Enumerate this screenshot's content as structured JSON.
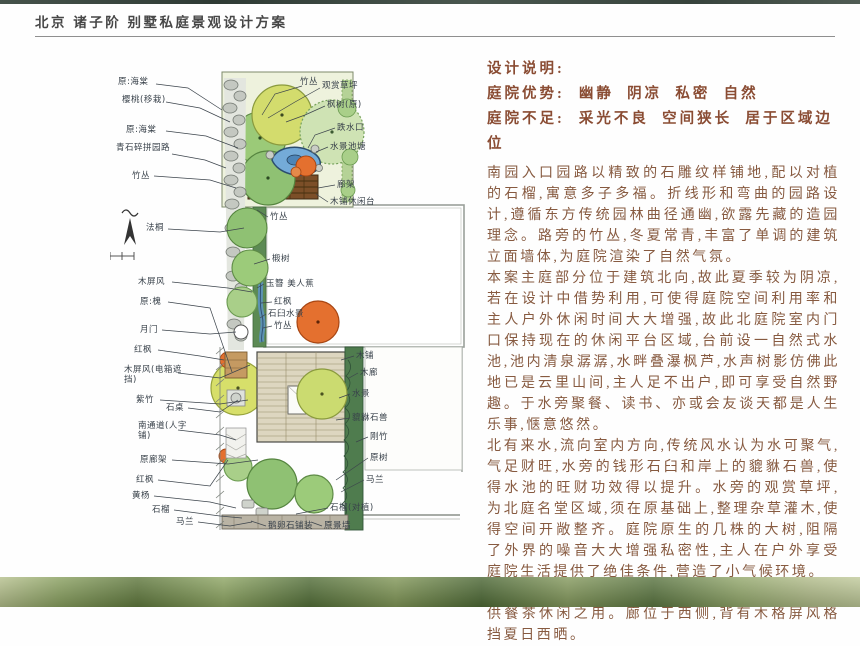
{
  "header": {
    "title": "北京 诸子阶 别墅私庭景观设计方案"
  },
  "design_notes": {
    "heading": "设计说明:",
    "pros_label": "庭院优势:",
    "pros": "幽静  阴凉  私密  自然",
    "cons_label": "庭院不足:",
    "cons": "采光不良  空间狭长  居于区域边位",
    "paragraphs": [
      "南园入口园路以精致的石雕纹样铺地,配以对植的石榴,寓意多子多福。折线形和弯曲的园路设计,遵循东方传统园林曲径通幽,欲露先藏的造园理念。路旁的竹丛,冬夏常青,丰富了单调的建筑立面墙体,为庭院渲染了自然气氛。",
      "本案主庭部分位于建筑北向,故此夏季较为阴凉,若在设计中借势利用,可使得庭院空间利用率和主人户外休闲时间大大增强,故此北庭院室内门口保持现在的休闲平台区域,台前设一自然式水池,池内清泉潺潺,水畔叠瀑枫芦,水声树影仿佛此地已是云里山间,主人足不出户,即可享受自然野趣。于水旁聚餐、读书、亦或会友谈天都是人生乐事,惬意悠然。",
      "北有来水,流向室内方向,传统风水认为水可聚气,气足财旺,水旁的钱形石臼和岸上的貔貅石兽,使得水池的旺财功效得以提升。水旁的观赏草坪,为北庭名堂区域,须在原基础上,整理杂草灌木,使得空间开敞整齐。庭院原生的几株的大树,阻隔了外界的噪音大大增强私密性,主人在户外享受庭院生活提供了绝佳条件,营造了小气候环境。",
      "露台的空间方正,又居于南向,可考虑设置一木廊,供餐茶休闲之用。廊位于西侧,背有木格屏风格挡夏日西晒。"
    ]
  },
  "plan": {
    "labels": [
      "原:海棠",
      "樱桃(移栽)",
      "原:海棠",
      "青石碎拼园路",
      "竹丛",
      "法桐",
      "木屏风",
      "原:槐",
      "月门",
      "红枫",
      "木屏风(电箱遮挡)",
      "紫竹",
      "石桌",
      "南通道(人字铺)",
      "原廊架",
      "红枫",
      "黄杨",
      "石榴",
      "马兰",
      "竹丛",
      "观赏草坪",
      "枫树(原)",
      "跌水口",
      "水景池塘",
      "廊架",
      "木铺休闲台",
      "竹丛",
      "椴树",
      "玉簪 美人蕉",
      "红枫",
      "石臼水景",
      "竹丛",
      "木铺",
      "木廊",
      "水景",
      "貔貅石兽",
      "刚竹",
      "原树",
      "马兰",
      "石榴(对植)",
      "鹅卵石铺装",
      "原景墙"
    ]
  },
  "colors": {
    "heading_brown": "#8a4c33",
    "body_brown": "#875a40",
    "tree_green": "#8fc173",
    "tree_yellow": "#d7df6a",
    "pond_blue": "#74abd8",
    "accent_orange": "#e4702f",
    "footer_green": "#546f3a",
    "topbar_green": "#37433c"
  }
}
